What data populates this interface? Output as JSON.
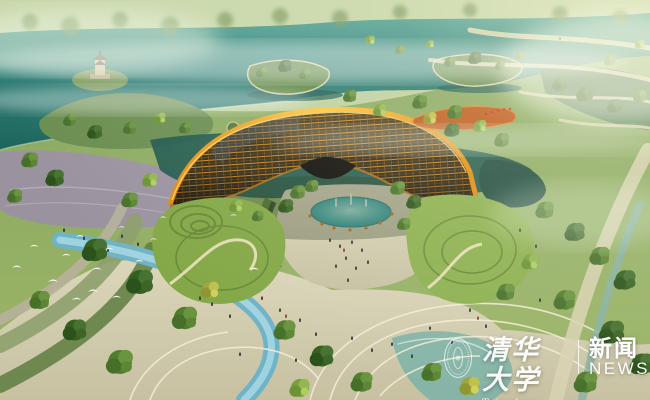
{
  "scene": {
    "type": "aerial architectural rendering",
    "subject": "Hazy sunlit park: a crescent-shaped amber lattice pavilion wraps a sunken garden courtyard with a turquoise fountain pond; misty teal lake, islands and a hilltop pagoda behind; terraced green mounds, winding pale paths, a blue stream and tree-lined plazas with visitors in front; a flock of white birds flies at the left"
  },
  "watermark": {
    "seal_icon": "tsinghua-university-seal",
    "university_name_zh": "清华大学",
    "university_name_en": "Tsinghua University",
    "news_label_zh": "新闻",
    "news_label_en": "NEWS"
  },
  "palette": {
    "lake_teal": "#2e7f76",
    "deep_water": "#17514a",
    "haze_green": "#cfe0bb",
    "canopy_amber": "#f09c18",
    "canopy_dark": "#2e2816",
    "pond_turquoise": "#49b2ae",
    "grass_mid": "#6f9440",
    "plaza_pale": "#d3cdae",
    "plaza_purple": "#9b92a0",
    "stream_blue": "#6fb3c6",
    "deck_orange": "#bf5c1e",
    "watermark_text": "#ffffff"
  }
}
